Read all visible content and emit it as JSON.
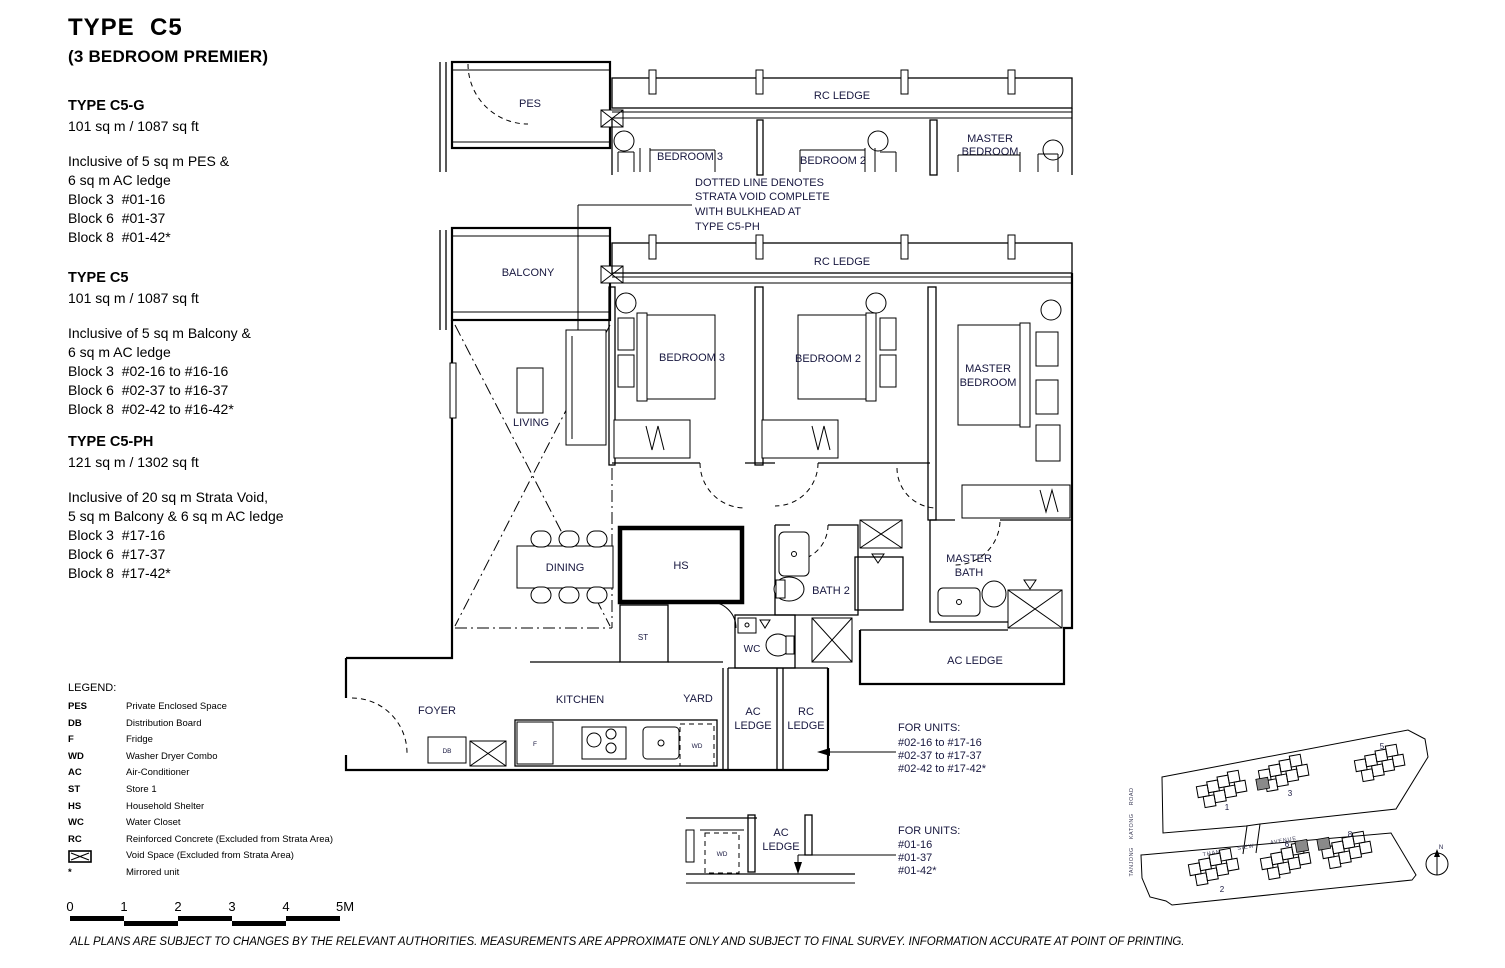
{
  "header": {
    "title": "TYPE  C5",
    "subtitle": "(3 BEDROOM PREMIER)"
  },
  "specs": [
    {
      "name": "TYPE C5-G",
      "area": "101 sq m / 1087 sq ft",
      "lines": [
        "Inclusive of 5 sq m PES &",
        "6 sq m AC ledge",
        "Block 3  #01-16",
        "Block 6  #01-37",
        "Block 8  #01-42*"
      ]
    },
    {
      "name": "TYPE C5",
      "area": "101 sq m / 1087 sq ft",
      "lines": [
        "Inclusive of 5 sq m Balcony &",
        "6 sq m AC ledge",
        "Block 3  #02-16 to #16-16",
        "Block 6  #02-37 to #16-37",
        "Block 8  #02-42 to #16-42*"
      ]
    },
    {
      "name": "TYPE C5-PH",
      "area": "121 sq m / 1302 sq ft",
      "lines": [
        "Inclusive of 20 sq m Strata Void,",
        "5 sq m Balcony & 6 sq m AC ledge",
        "Block 3  #17-16",
        "Block 6  #17-37",
        "Block 8  #17-42*"
      ]
    }
  ],
  "legend": {
    "title": "LEGEND:",
    "items": [
      {
        "term": "PES",
        "desc": "Private Enclosed Space"
      },
      {
        "term": "DB",
        "desc": "Distribution Board"
      },
      {
        "term": "F",
        "desc": "Fridge"
      },
      {
        "term": "WD",
        "desc": "Washer Dryer Combo"
      },
      {
        "term": "AC",
        "desc": "Air-Conditioner"
      },
      {
        "term": "ST",
        "desc": "Store 1"
      },
      {
        "term": "HS",
        "desc": "Household Shelter"
      },
      {
        "term": "WC",
        "desc": "Water Closet"
      },
      {
        "term": "RC",
        "desc": "Reinforced Concrete (Excluded from Strata Area)"
      },
      {
        "term": "",
        "desc": "Void Space (Excluded from Strata Area)"
      },
      {
        "term": "*",
        "desc": "Mirrored unit"
      }
    ]
  },
  "scalebar": {
    "labels": [
      "0",
      "1",
      "2",
      "3",
      "4",
      "5M"
    ]
  },
  "disclaimer": "ALL PLANS ARE SUBJECT TO CHANGES BY THE RELEVANT AUTHORITIES. MEASUREMENTS ARE APPROXIMATE ONLY AND SUBJECT TO FINAL SURVEY. INFORMATION ACCURATE AT POINT OF PRINTING.",
  "floorplan": {
    "labels": {
      "pes": "PES",
      "balcony": "BALCONY",
      "rc_ledge": "RC LEDGE",
      "bedroom3": "BEDROOM 3",
      "bedroom2": "BEDROOM 2",
      "master1": "MASTER",
      "master2": "BEDROOM",
      "living": "LIVING",
      "dining": "DINING",
      "hs": "HS",
      "bath2": "BATH 2",
      "mbath1": "MASTER",
      "mbath2": "BATH",
      "st": "ST",
      "wc": "WC",
      "ac_ledge": "AC LEDGE",
      "kitchen": "KITCHEN",
      "yard": "YARD",
      "foyer": "FOYER",
      "db": "DB",
      "f": "F",
      "wd": "WD",
      "ac": "AC",
      "rc": "RC",
      "ledge": "LEDGE"
    },
    "annotation": {
      "line1": "DOTTED LINE DENOTES",
      "line2": "STRATA VOID COMPLETE",
      "line3": "WITH BULKHEAD AT",
      "line4": "TYPE C5-PH"
    },
    "for_units_upper": {
      "title": "FOR UNITS:",
      "lines": [
        "#02-16 to #17-16",
        "#02-37 to #17-37",
        "#02-42 to #17-42*"
      ]
    },
    "for_units_lower": {
      "title": "FOR UNITS:",
      "lines": [
        "#01-16",
        "#01-37",
        "#01-42*"
      ]
    }
  },
  "sitemap": {
    "road_left": "TANJONG KATONG ROAD",
    "road_center": "THAM SIEW AVENUE",
    "blocks": [
      "1",
      "3",
      "5",
      "2",
      "6",
      "8"
    ],
    "north": "N"
  }
}
